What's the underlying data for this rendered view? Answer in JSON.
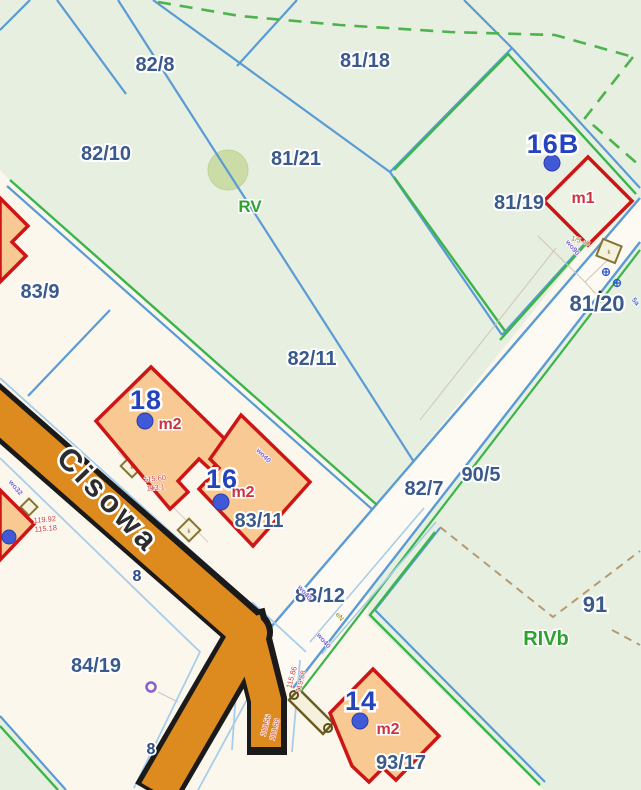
{
  "map": {
    "parcels": {
      "p82_8": "82/8",
      "p81_18": "81/18",
      "p82_10": "82/10",
      "p81_21": "81/21",
      "p81_19": "81/19",
      "p81_20": "81/20",
      "p83_9": "83/9",
      "p82_11": "82/11",
      "p82_7": "82/7",
      "p90_5": "90/5",
      "p83_11": "83/11",
      "p83_12": "83/12",
      "p91": "91",
      "p84_19": "84/19",
      "p93_17": "93/17"
    },
    "building_numbers": {
      "n16B": "16B",
      "n18": "18",
      "n16": "16",
      "n14": "14"
    },
    "building_uses": {
      "m1": "m1",
      "m2_18": "m2",
      "m2_16": "m2",
      "m2_14": "m2"
    },
    "soil_classes": {
      "rv": "RV",
      "rivb": "RIVb"
    },
    "street": {
      "name": "Cisowa"
    },
    "house_numbers": {
      "a": "8",
      "b": "8"
    },
    "utility_labels": {
      "wo90": "wo90",
      "wo40_a": "wo40",
      "wo40_b": "wo40",
      "wo40_c": "wo40",
      "wo32": "wo32",
      "en": "eN",
      "ref_5a": "5a",
      "k_mark": "k"
    },
    "measurements": {
      "r1a": "115.60",
      "r1b": "113.1",
      "r2a": "119.92",
      "r2b": "115.18",
      "r3a": "115.86",
      "r3b": "119.08",
      "r4a": "118.56",
      "r4b": "118.88",
      "sq_ref": "1/5.40"
    },
    "colors": {
      "background_green": "#e7efe0",
      "background_cream": "#fbf7ec",
      "parcel_line_blue": "#5b9bd5",
      "boundary_green": "#3bb54a",
      "dashed_green": "#4db34d",
      "dashed_brown": "#b59b72",
      "building_outline_red": "#ce1515",
      "building_fill_peach": "#f8c993",
      "street_orange": "#dd8a1e",
      "street_casing_black": "#1a1a1a",
      "label_blue": "#3a5a8c",
      "building_number_blue": "#2443bd",
      "use_label_red": "#cc3340",
      "soil_label_green": "#2ea22e",
      "measurement_red": "#cf4040",
      "utility_purple": "#7a5fd0",
      "dot_blue": "#4059d6"
    }
  }
}
